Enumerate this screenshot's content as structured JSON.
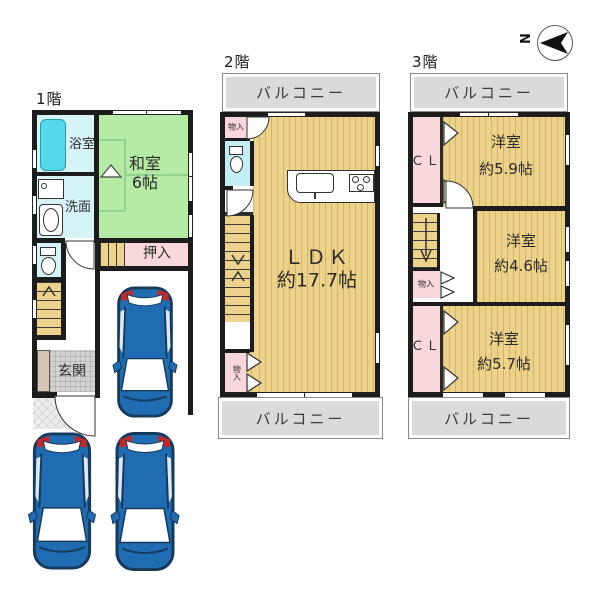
{
  "compass": {
    "north_label": "N"
  },
  "floors": {
    "f1": {
      "title": "1階",
      "bath": "浴室",
      "washroom": "洗面",
      "tatami_room": "和室",
      "tatami_size": "6帖",
      "closet": "押入",
      "entrance": "玄関"
    },
    "f2": {
      "title": "2階",
      "balcony_top": "バルコニー",
      "balcony_bottom": "バルコニー",
      "storage_top": "物入",
      "storage_bottom": "物入",
      "ldk": "ＬＤＫ",
      "ldk_size": "約17.7帖"
    },
    "f3": {
      "title": "3階",
      "balcony_top": "バルコニー",
      "balcony_bottom": "バルコニー",
      "closet_top": "ＣＬ",
      "closet_bottom": "ＣＬ",
      "storage": "物入",
      "room_a": "洋室",
      "room_a_size": "約5.9帖",
      "room_b": "洋室",
      "room_b_size": "約4.6帖",
      "room_c": "洋室",
      "room_c_size": "約5.7帖"
    }
  },
  "colors": {
    "wall": "#1c1c1c",
    "wood": "#ecd28a",
    "woodline": "#d6b466",
    "tatami": "#b6eba5",
    "tatamiline": "#8fd492",
    "pink": "#f9d8dc",
    "cyanroom": "#d6f4f8",
    "tub": "#55d9ea",
    "balcony": "#dadada",
    "genkan": "#d2d2d2",
    "porch": "#ededed",
    "carblue": "#1f6cb2",
    "cardark": "#17395a",
    "carred": "#c92727"
  }
}
